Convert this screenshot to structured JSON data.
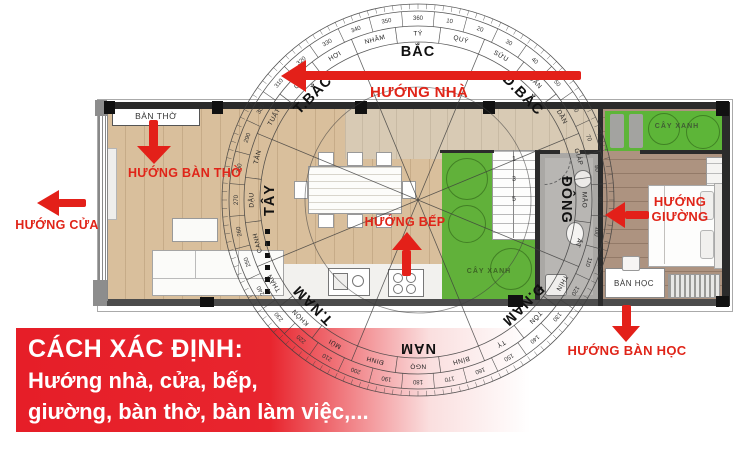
{
  "banner": {
    "title": "CÁCH XÁC ĐỊNH:",
    "line1": "Hướng nhà, cửa, bếp,",
    "line2": "giường, bàn thờ, bàn làm việc,..."
  },
  "arrows": {
    "huong_nha": "HƯỚNG NHÀ",
    "huong_cua": "HƯỚNG CỬA",
    "huong_ban_tho": "HƯỚNG BÀN THỜ",
    "huong_bep": "HƯỚNG BẾP",
    "huong_giuong_line1": "HƯỚNG",
    "huong_giuong_line2": "GIƯỜNG",
    "huong_ban_hoc": "HƯỚNG BÀN HỌC"
  },
  "plan": {
    "altar_label": "BÀN THỜ",
    "desk_label": "BÀN HỌC",
    "green_label_1": "CÂY XANH",
    "green_label_2": "CÂY XANH",
    "stair_numbers": [
      "1",
      "3",
      "5"
    ]
  },
  "compass": {
    "sectors": [
      {
        "label": "BẮC",
        "angle": 0
      },
      {
        "label": "Đ.BẮC",
        "angle": 45
      },
      {
        "label": "ĐÔNG",
        "angle": 90
      },
      {
        "label": "Đ.NAM",
        "angle": 135
      },
      {
        "label": "NAM",
        "angle": 180
      },
      {
        "label": "T.NAM",
        "angle": 225
      },
      {
        "label": "TÂY",
        "angle": 270
      },
      {
        "label": "T.BẮC",
        "angle": 315
      }
    ],
    "mountains": [
      {
        "label": "TÝ",
        "angle": 0
      },
      {
        "label": "QUÝ",
        "angle": 15
      },
      {
        "label": "SỬU",
        "angle": 30
      },
      {
        "label": "CẤN",
        "angle": 45
      },
      {
        "label": "DẦN",
        "angle": 60
      },
      {
        "label": "GIÁP",
        "angle": 75
      },
      {
        "label": "MÃO",
        "angle": 90
      },
      {
        "label": "ẤT",
        "angle": 105
      },
      {
        "label": "THÌN",
        "angle": 120
      },
      {
        "label": "TỐN",
        "angle": 135
      },
      {
        "label": "TỴ",
        "angle": 150
      },
      {
        "label": "BÍNH",
        "angle": 165
      },
      {
        "label": "NGỌ",
        "angle": 180
      },
      {
        "label": "ĐINH",
        "angle": 195
      },
      {
        "label": "MÙI",
        "angle": 210
      },
      {
        "label": "KHÔN",
        "angle": 225
      },
      {
        "label": "THÂN",
        "angle": 240
      },
      {
        "label": "CANH",
        "angle": 255
      },
      {
        "label": "DẬU",
        "angle": 270
      },
      {
        "label": "TÂN",
        "angle": 285
      },
      {
        "label": "TUẤT",
        "angle": 300
      },
      {
        "label": "CÀN",
        "angle": 315
      },
      {
        "label": "HỢI",
        "angle": 330
      },
      {
        "label": "NHÂM",
        "angle": 345
      }
    ],
    "degrees": [
      {
        "label": "10",
        "angle": 10
      },
      {
        "label": "20",
        "angle": 20
      },
      {
        "label": "30",
        "angle": 30
      },
      {
        "label": "40",
        "angle": 40
      },
      {
        "label": "50",
        "angle": 50
      },
      {
        "label": "60",
        "angle": 60
      },
      {
        "label": "70",
        "angle": 70
      },
      {
        "label": "80",
        "angle": 80
      },
      {
        "label": "90",
        "angle": 90
      },
      {
        "label": "100",
        "angle": 100
      },
      {
        "label": "110",
        "angle": 110
      },
      {
        "label": "120",
        "angle": 120
      },
      {
        "label": "130",
        "angle": 130
      },
      {
        "label": "140",
        "angle": 140
      },
      {
        "label": "150",
        "angle": 150
      },
      {
        "label": "160",
        "angle": 160
      },
      {
        "label": "170",
        "angle": 170
      },
      {
        "label": "180",
        "angle": 180
      },
      {
        "label": "190",
        "angle": 190
      },
      {
        "label": "200",
        "angle": 200
      },
      {
        "label": "210",
        "angle": 210
      },
      {
        "label": "220",
        "angle": 220
      },
      {
        "label": "230",
        "angle": 230
      },
      {
        "label": "240",
        "angle": 240
      },
      {
        "label": "250",
        "angle": 250
      },
      {
        "label": "260",
        "angle": 260
      },
      {
        "label": "270",
        "angle": 270
      },
      {
        "label": "280",
        "angle": 280
      },
      {
        "label": "290",
        "angle": 290
      },
      {
        "label": "300",
        "angle": 300
      },
      {
        "label": "310",
        "angle": 310
      },
      {
        "label": "320",
        "angle": 320
      },
      {
        "label": "330",
        "angle": 330
      },
      {
        "label": "340",
        "angle": 340
      },
      {
        "label": "350",
        "angle": 350
      },
      {
        "label": "360",
        "angle": 0
      }
    ]
  },
  "colors": {
    "accent_red": "#e32019",
    "banner_red": "#e71e28",
    "living_wood": "#d9bf9c",
    "hall_wood": "#d8cab4",
    "bedroom_wood": "#ad9380",
    "green": "#61b13a",
    "bathroom_gray": "#b8b6b3",
    "wall_dark": "#2b2b2b"
  }
}
